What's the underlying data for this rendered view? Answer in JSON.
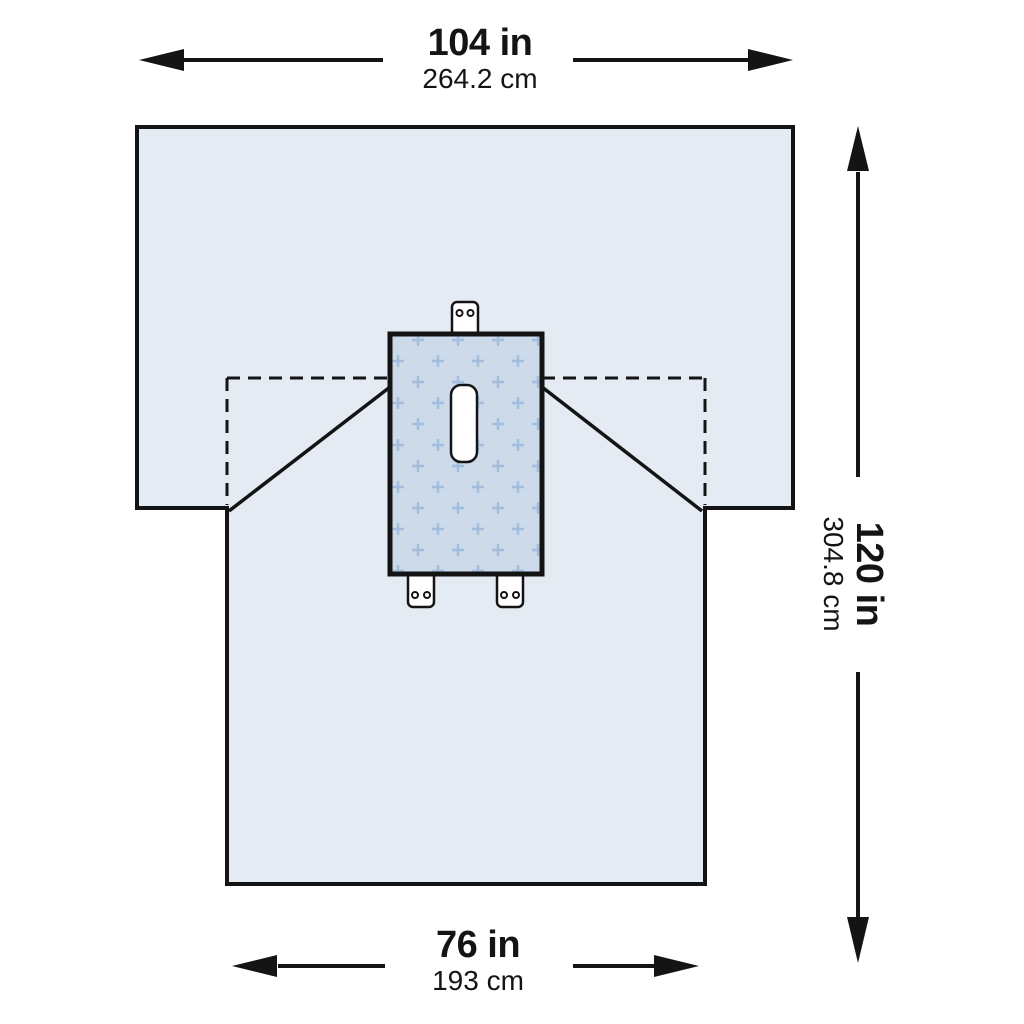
{
  "diagram": {
    "dimensions": {
      "top_width": {
        "inches": "104 in",
        "centimeters": "264.2 cm"
      },
      "side_length": {
        "inches": "120 in",
        "centimeters": "304.8 cm"
      },
      "bottom_width": {
        "inches": "76 in",
        "centimeters": "193 cm"
      }
    },
    "colors": {
      "line": "#141414",
      "drape_fill": "#e5ebf3",
      "panel_fill": "#ccdaea",
      "cross_color": "#a2bedf",
      "opening_fill": "#ffffff",
      "background": "#ffffff"
    }
  }
}
